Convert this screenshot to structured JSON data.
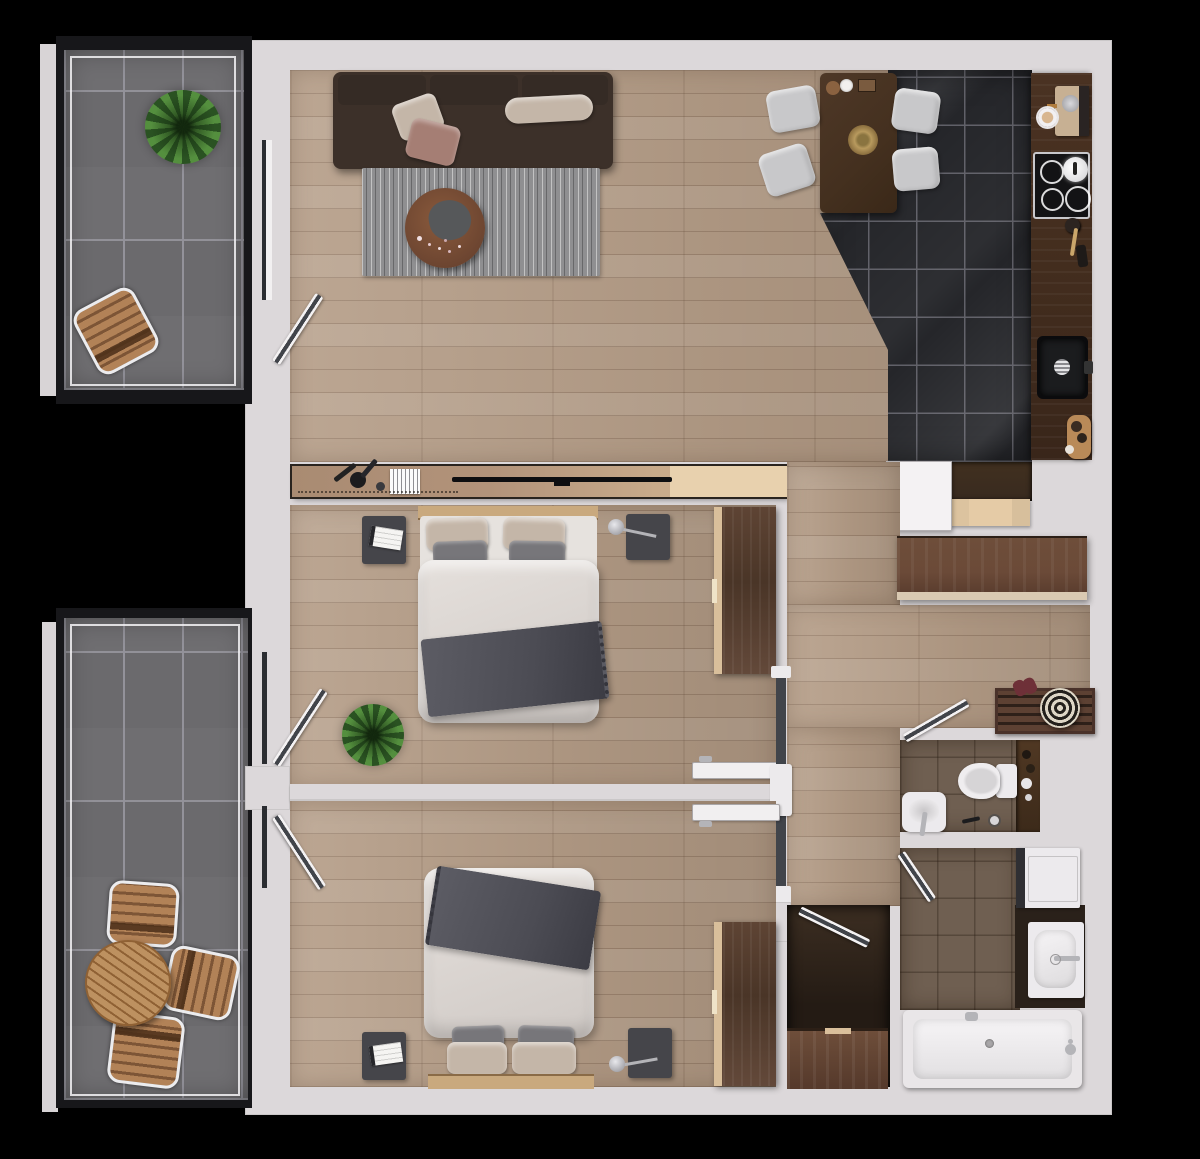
{
  "scene": {
    "type": "apartment-floor-plan-3d-render",
    "background": "black",
    "rooms": [
      {
        "name": "balcony-top-left",
        "floor": "dark-gray-tile",
        "items": [
          "potted-plant",
          "wooden-folding-chair"
        ]
      },
      {
        "name": "living-dining-room",
        "floor": "light-oak-plank",
        "items": [
          "sofa",
          "throw-pillows",
          "area-rug",
          "round-coffee-table",
          "tv-console-sideboard",
          "dining-table",
          "dining-chair",
          "dining-chair",
          "dining-chair",
          "dining-chair"
        ]
      },
      {
        "name": "kitchen",
        "floor": "black-marble-tile",
        "items": [
          "counter-run",
          "coffee-machine",
          "coffee-cup",
          "cooktop",
          "kettle",
          "utensil-jar",
          "sink",
          "cutting-board"
        ]
      },
      {
        "name": "entry-hall",
        "floor": "light-oak-plank",
        "items": [
          "entry-door",
          "door-mat",
          "shoe-bench",
          "sideboard",
          "slat-bench",
          "round-basket",
          "shoes"
        ]
      },
      {
        "name": "bedroom-1",
        "floor": "light-oak-plank",
        "items": [
          "double-bed",
          "nightstand",
          "nightstand",
          "table-lamp",
          "magazines",
          "wardrobe",
          "potted-plant",
          "balcony-door",
          "hall-door"
        ]
      },
      {
        "name": "bedroom-2",
        "floor": "light-oak-plank",
        "items": [
          "double-bed",
          "nightstand",
          "nightstand",
          "table-lamp",
          "magazines",
          "wardrobe",
          "balcony-door",
          "hall-door"
        ]
      },
      {
        "name": "wc",
        "floor": "brown-tile",
        "items": [
          "toilet",
          "washbasin",
          "vanity-shelf",
          "door"
        ]
      },
      {
        "name": "bathroom",
        "floor": "brown-tile",
        "items": [
          "washing-machine",
          "washbasin-counter",
          "bathtub",
          "door"
        ]
      },
      {
        "name": "terrace-bottom-left",
        "floor": "dark-gray-tile",
        "items": [
          "round-wooden-table",
          "wooden-folding-chair",
          "wooden-folding-chair",
          "wooden-folding-chair"
        ]
      },
      {
        "name": "storage-closet",
        "floor": "dark-wood",
        "items": [
          "cabinet",
          "door"
        ]
      }
    ]
  },
  "colors": {
    "bg": "#000000",
    "wall": "#dcd8da",
    "wood": "#b49c86",
    "balcony_tile": "#6f6e71",
    "balcony_grout": "#93929a",
    "balcony_frame": "#17171a",
    "kitchen_tile": "#25262a",
    "kitchen_grout": "#606068",
    "counter": "#432d1e",
    "walnut": "#5d4334",
    "walnut_light": "#6b4a38",
    "wood_trim": "#d9bf9b",
    "console": "#b2937a",
    "console_light": "#e8d1ae",
    "sofa": "#3c3029",
    "cushion": "#352b25",
    "pillow_beige": "#c4b6a8",
    "pillow_mauve": "#a57e74",
    "pillow_gray": "#77767a",
    "rug": "#8f8f91",
    "duvet": "#dcd7d3",
    "throw": "#4c4c54",
    "bedframe": "#c9a97e",
    "nightstand": "#45454a",
    "dining_table": "#44301f",
    "chair_gray": "#c8c8ca",
    "white_fix": "#eceaed",
    "bath_tile": "#6f5f51",
    "mat": "#382a1f",
    "bench": "#e5cba6",
    "metal": "#b4b4b8",
    "plant_dark": "#2a5222",
    "plant_light": "#548f3e",
    "glass": "#41444a",
    "closet_floor": "#241b14",
    "basket_light": "#ddd6c6",
    "basket_dark": "#23201c",
    "shoe": "#6e3038",
    "gold": "#b89a5e"
  }
}
